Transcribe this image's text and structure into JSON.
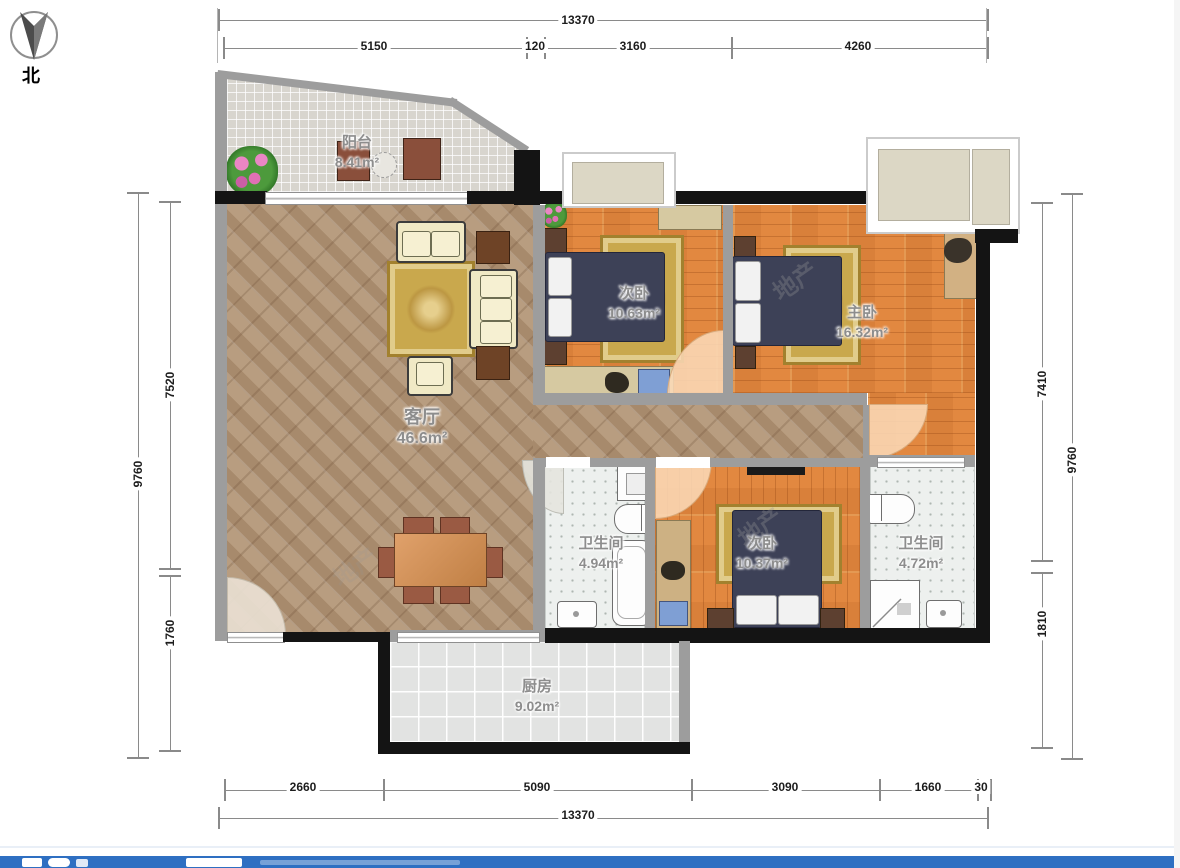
{
  "north": {
    "label": "北"
  },
  "dims": {
    "top_outer": "13370",
    "top_inner": [
      "5150",
      "120",
      "3160",
      "4260"
    ],
    "bottom_inner": [
      "2660",
      "5090",
      "3090",
      "1660",
      "30"
    ],
    "bottom_outer": "13370",
    "left_outer": "9760",
    "left_inner": [
      "7520",
      "1760"
    ],
    "right_inner": [
      "7410",
      "1810"
    ],
    "right_outer": "9760"
  },
  "rooms": {
    "balcony": {
      "name": "阳台",
      "area": "8.41m²"
    },
    "living": {
      "name": "客厅",
      "area": "46.6m²"
    },
    "bedroom_top": {
      "name": "次卧",
      "area": "10.63m²"
    },
    "master": {
      "name": "主卧",
      "area": "16.32m²"
    },
    "bath_left": {
      "name": "卫生间",
      "area": "4.94m²"
    },
    "bedroom_bottom": {
      "name": "次卧",
      "area": "10.37m²"
    },
    "bath_right": {
      "name": "卫生间",
      "area": "4.72m²"
    },
    "kitchen": {
      "name": "厨房",
      "area": "9.02m²"
    }
  },
  "watermark": {
    "text": "地产"
  },
  "colors": {
    "wood": "#e28840",
    "marble": "#b09374",
    "bed_navy": "#3d4157",
    "rug_gold": "#c9a84d",
    "bath_tile": "#edf0ee",
    "kitchen_tile": "#e2e3e2",
    "balcony_tile": "#d8d5ce",
    "wall_black": "#141414",
    "wall_gray": "#9d9d9d",
    "dim_line": "#8a8a8a",
    "footer_blue": "#2e6fc2"
  }
}
